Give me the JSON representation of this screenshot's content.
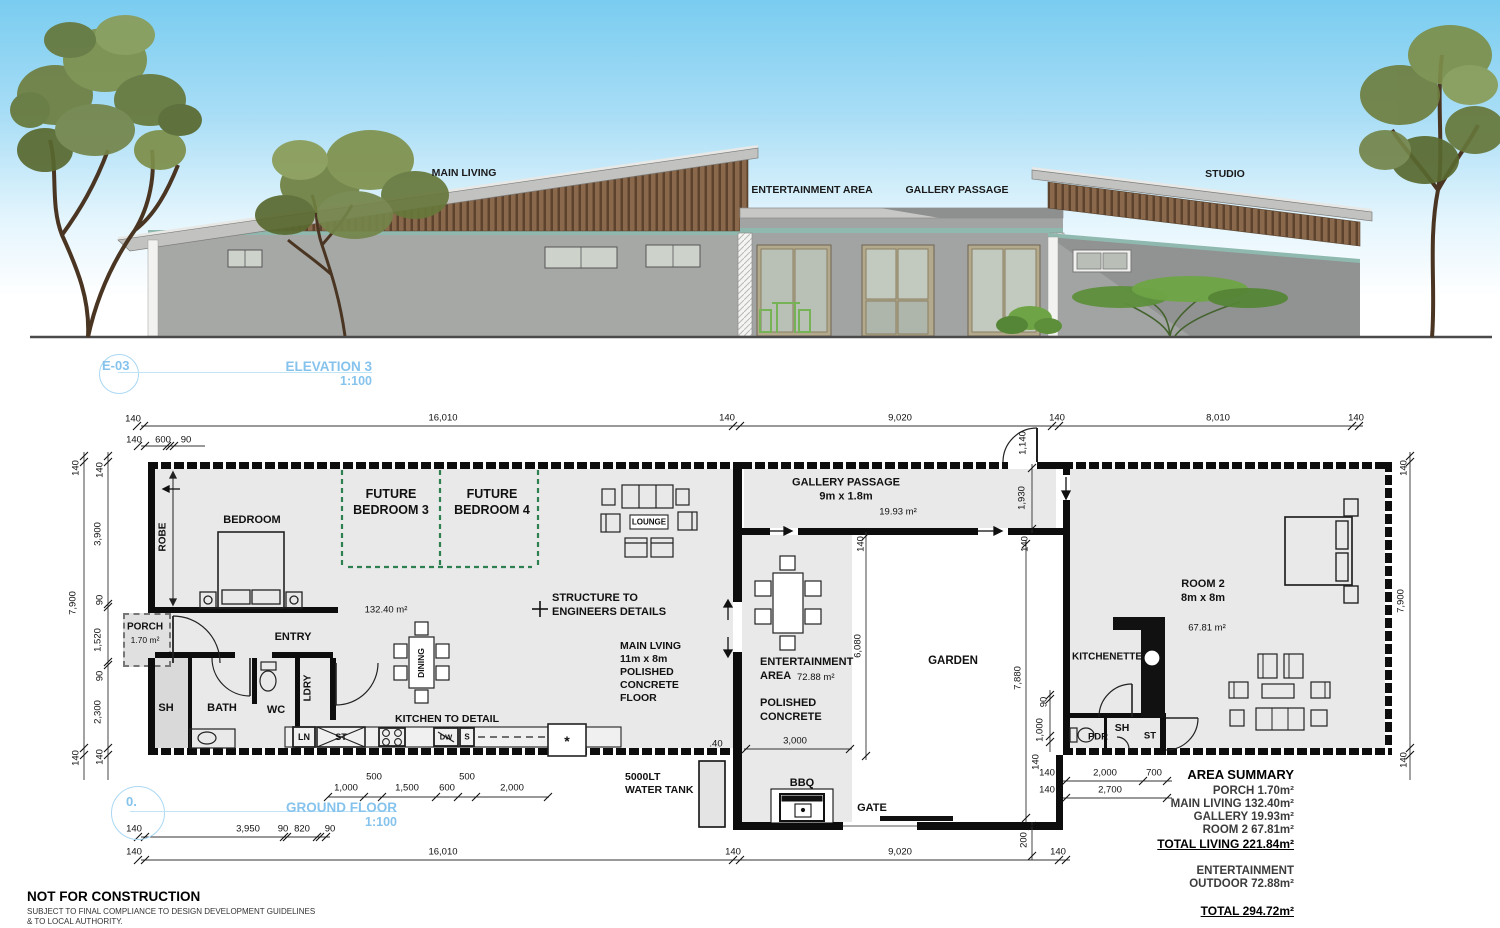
{
  "elevation": {
    "badge": "E-03",
    "title": "ELEVATION 3",
    "scale": "1:100",
    "labels": {
      "main_living": "MAIN LIVING",
      "entertainment": "ENTERTAINMENT AREA",
      "gallery": "GALLERY PASSAGE",
      "studio": "STUDIO"
    }
  },
  "plan": {
    "badge": "0.",
    "title": "GROUND FLOOR",
    "scale": "1:100",
    "rooms": {
      "robe": "ROBE",
      "bedroom": "BEDROOM",
      "future3": "FUTURE\nBEDROOM 3",
      "future4": "FUTURE\nBEDROOM 4",
      "lounge": "LOUNGE",
      "area_main": "132.40 m²",
      "dining": "DINING",
      "structure": "STRUCTURE TO\nENGINEERS DETAILS",
      "main_living": "MAIN LVING\n11m x 8m\nPOLISHED\nCONCRETE\nFLOOR",
      "kitchen": "KITCHEN TO DETAIL",
      "porch": "PORCH",
      "porch_area": "1.70 m²",
      "entry": "ENTRY",
      "sh": "SH",
      "bath": "BATH",
      "wc": "WC",
      "ldry": "LDRY",
      "ln": "LN",
      "st": "ST",
      "dw": "DW",
      "s": "S",
      "star": "*",
      "gallery": "GALLERY PASSAGE\n9m x 1.8m",
      "gallery_area": "19.93 m²",
      "ent1": "ENTERTAINMENT",
      "ent2": "AREA",
      "ent_area": "72.88 m²",
      "polished": "POLISHED\nCONCRETE",
      "garden": "GARDEN",
      "bbq": "BBQ",
      "gate": "GATE",
      "tank": "5000LT\nWATER TANK",
      "kitchenette": "KITCHENETTE",
      "room2": "ROOM 2\n8m x 8m",
      "room2_area": "67.81 m²",
      "pdr": "PDR",
      "sh2": "SH",
      "st2": "ST"
    },
    "dims": {
      "top1": [
        "140",
        "16,010",
        "140",
        "9,020",
        "140",
        "8,010",
        "140"
      ],
      "top2": [
        "140",
        "600",
        "90"
      ],
      "door_top": "1,140",
      "left_outer": [
        "140",
        "7,900",
        "140"
      ],
      "left_inner": [
        "140",
        "3,900",
        "90",
        "1,520",
        "90",
        "2,300",
        "140"
      ],
      "right_outer": [
        "140",
        "7,900",
        "140"
      ],
      "v1930": "1,930",
      "g140a": "140",
      "g140b": "140",
      "h6080": "6,080",
      "h7880": "7,880",
      "e3000": "3,000",
      "p40": ".40",
      "k90": "90",
      "k1000": "1,000",
      "k140": "140",
      "g200": "200",
      "kitchen": [
        "1,000",
        "500",
        "1,500",
        "600",
        "500",
        "2,000"
      ],
      "br1": [
        "140",
        "2,000",
        "700"
      ],
      "br2": [
        "140",
        "2,700"
      ],
      "bot1": [
        "140",
        "3,950",
        "90",
        "820",
        "90"
      ],
      "bot2": [
        "140",
        "16,010",
        "140",
        "9,020",
        "140"
      ]
    }
  },
  "area_summary": {
    "title": "AREA SUMMARY",
    "lines": [
      "PORCH 1.70m²",
      "MAIN LIVING 132.40m²",
      "GALLERY 19.93m²",
      "ROOM 2 67.81m²"
    ],
    "total_living": "TOTAL LIVING 221.84m²",
    "outdoor1": "ENTERTAINMENT",
    "outdoor2": "OUTDOOR 72.88m²",
    "total": "TOTAL 294.72m²"
  },
  "footer": {
    "title": "NOT FOR CONSTRUCTION",
    "note": "SUBJECT TO FINAL COMPLIANCE TO DESIGN DEVELOPMENT GUIDELINES\n& TO LOCAL AUTHORITY."
  }
}
